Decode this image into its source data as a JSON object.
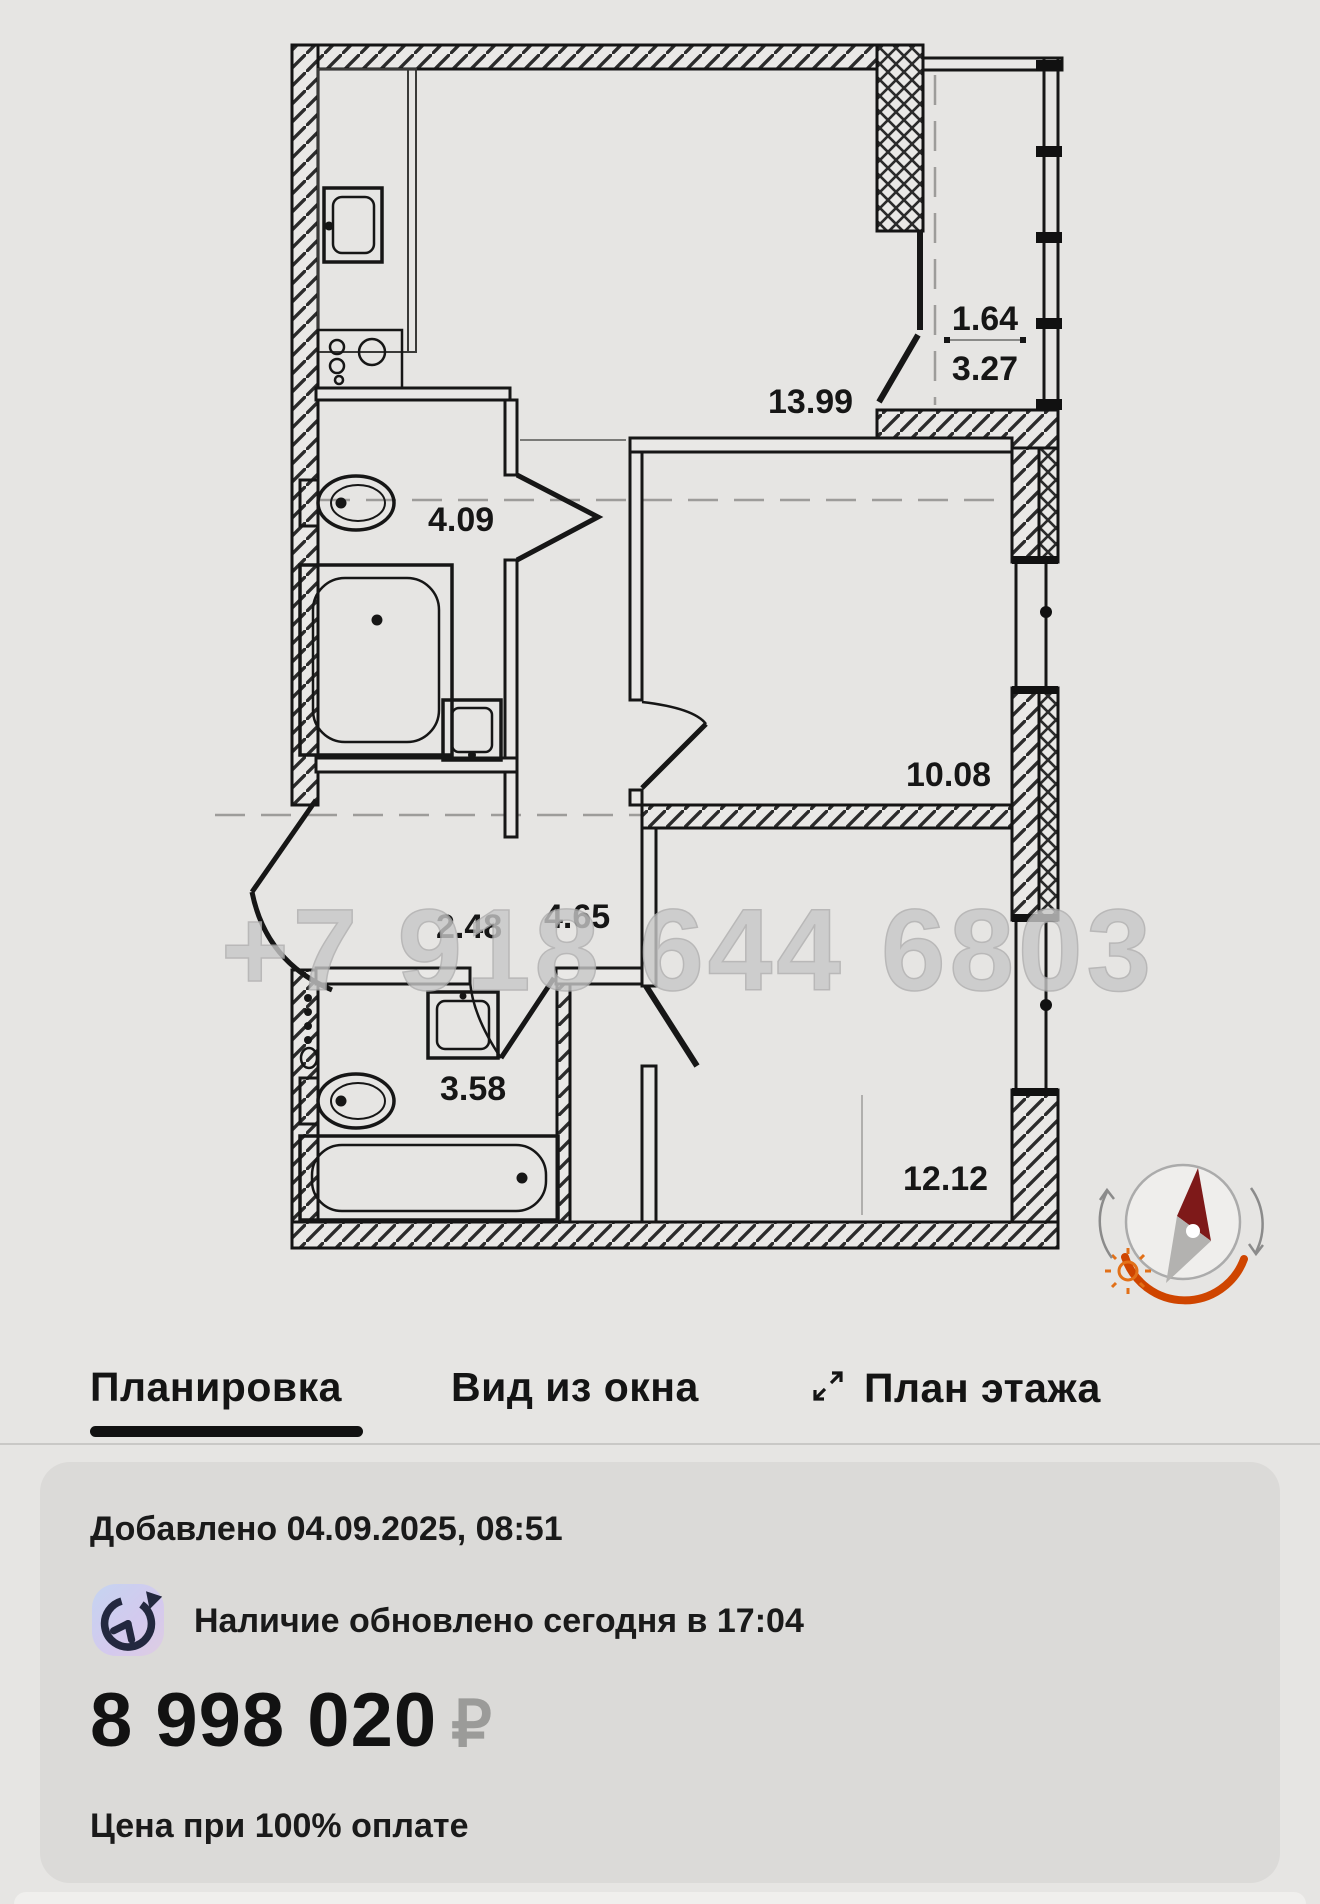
{
  "watermark": {
    "text": "+7 918 644 6803"
  },
  "plan": {
    "rooms": [
      {
        "id": "kitchen-living",
        "area": "13.99"
      },
      {
        "id": "balcony-top",
        "area": "1.64"
      },
      {
        "id": "balcony-bottom",
        "area": "3.27"
      },
      {
        "id": "bathroom-1",
        "area": "4.09"
      },
      {
        "id": "bedroom",
        "area": "10.08"
      },
      {
        "id": "hall",
        "area": "2.48"
      },
      {
        "id": "corridor",
        "area": "4.65"
      },
      {
        "id": "bathroom-2",
        "area": "3.58"
      },
      {
        "id": "living-room",
        "area": "12.12"
      }
    ]
  },
  "tabs": {
    "items": [
      {
        "label": "Планировка",
        "active": true
      },
      {
        "label": "Вид из окна",
        "active": false
      },
      {
        "label": "План этажа",
        "active": false
      }
    ]
  },
  "card": {
    "added_line": "Добавлено 04.09.2025, 08:51",
    "availability_line": "Наличие обновлено сегодня в 17:04",
    "price_value": "8 998 020",
    "price_currency": "₽",
    "price_note": "Цена при 100% оплате"
  },
  "colors": {
    "tab_underline": "#111111",
    "compass_needle": "#7e1919",
    "compass_arc": "#cf4500",
    "watermark": "#c8c8c8",
    "card_bg": "#dbdad8"
  }
}
